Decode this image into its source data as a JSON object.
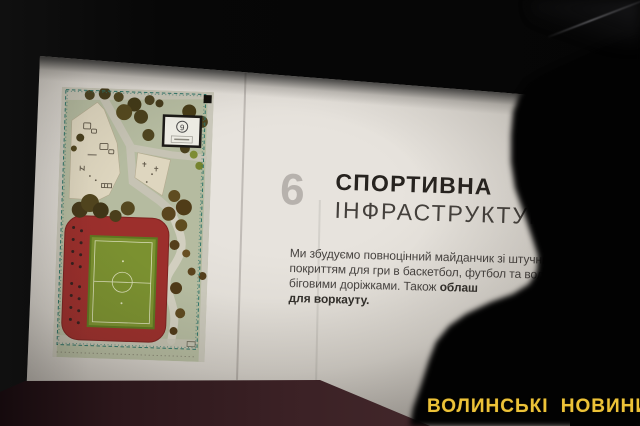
{
  "photo": {
    "watermark_text": "ВОЛИНСЬКІ НОВИНИ",
    "watermark_color": "#ecc238",
    "scene": "presentation board photographed in dark room, person silhouette at right"
  },
  "slide": {
    "number": "6",
    "title": "СПОРТИВНА",
    "subtitle": "ІНФРАСТРУКТУРА",
    "paragraph_lines": [
      {
        "regular": "Ми збудуємо повноцінний майданчик зі штучним",
        "bold": ""
      },
      {
        "regular": "покриттям для гри в баскетбол, футбол та воле",
        "bold": ""
      },
      {
        "regular": "біговими доріжками. Також ",
        "bold": "облаш"
      },
      {
        "regular": "",
        "bold": "для воркауту."
      }
    ],
    "site_plan": {
      "callout_number": "9",
      "colors": {
        "ground": "#b5bba0",
        "track_red": "#9c2f2c",
        "field_green": "#7b9130",
        "field_lines": "#d9ddb8",
        "paths": "#c6c3b4",
        "playground_beige": "#ded6bf",
        "fence_teal": "#2f7468",
        "trees_dark": "#4a401e"
      }
    }
  },
  "environment": {
    "background": "#070707",
    "table_maroon": "#3b2125",
    "slide_paper": "#dcd8d2"
  }
}
